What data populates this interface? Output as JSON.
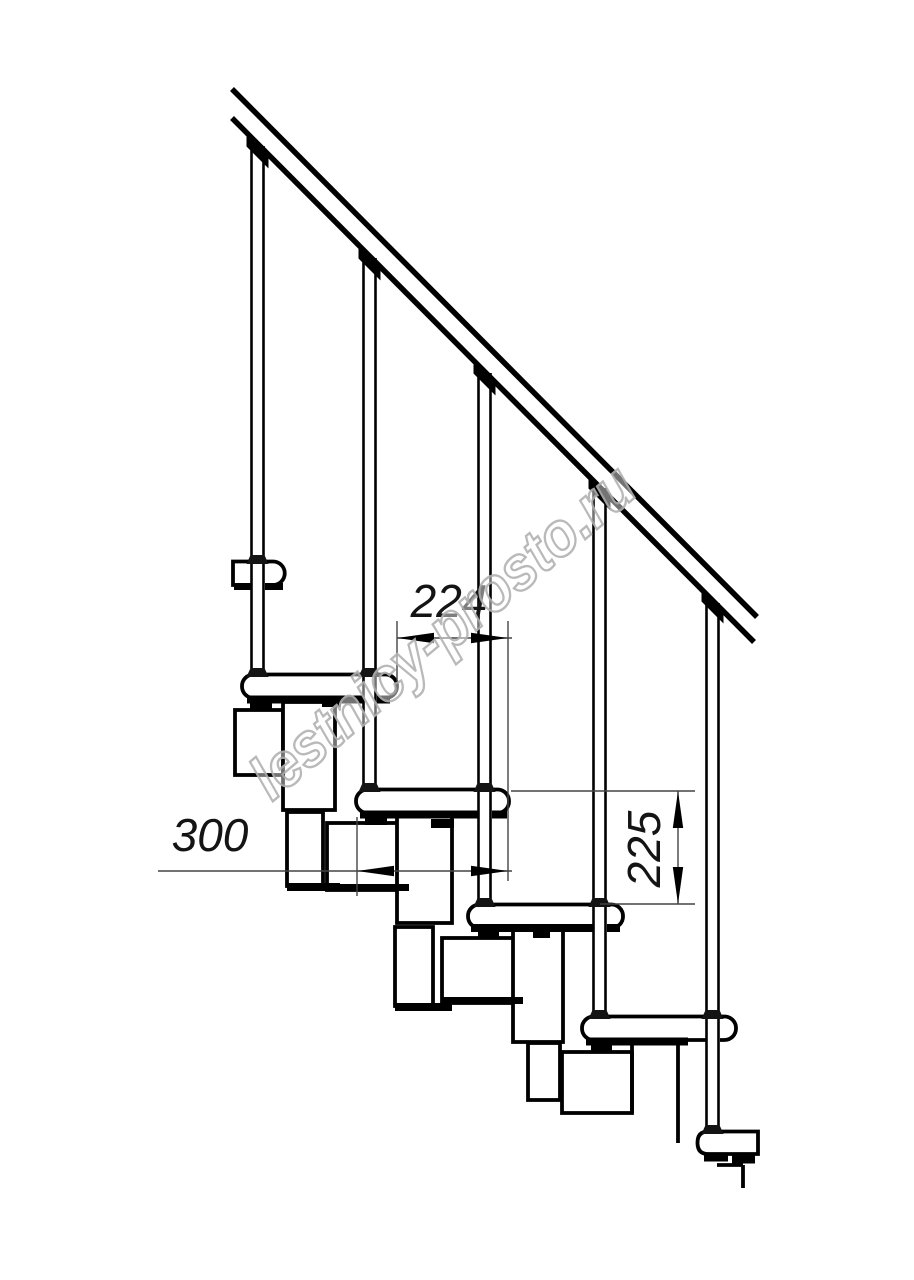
{
  "drawing": {
    "kind": "modular staircase side elevation drawing",
    "steps_visible": 6,
    "balusters_visible": 5
  },
  "dimensions": {
    "going": {
      "label": "224"
    },
    "tread_depth": {
      "label": "300"
    },
    "riser_height": {
      "label": "225"
    }
  },
  "watermark": {
    "text": "lestnicy-prosto.ru",
    "outline_color": "#b2b2b2"
  },
  "colors": {
    "background": "#ffffff",
    "line": "#000000",
    "dimension_line": "#444444",
    "dimension_text": "#141414"
  }
}
